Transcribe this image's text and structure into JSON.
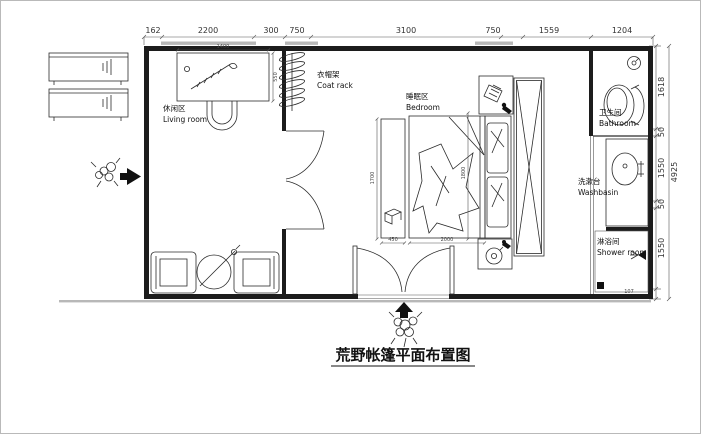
{
  "title": "荒野帐篷平面布置图",
  "rooms": {
    "living": {
      "zh": "休闲区",
      "en": "Living room"
    },
    "coat_rack": {
      "zh": "衣帽架",
      "en": "Coat rack"
    },
    "bedroom": {
      "zh": "睡眠区",
      "en": "Bedroom"
    },
    "bathroom": {
      "zh": "卫生间",
      "en": "Bathroom"
    },
    "washbasin": {
      "zh": "洗漱台",
      "en": "Washbasin"
    },
    "shower": {
      "zh": "淋浴间",
      "en": "Shower room"
    }
  },
  "dims": {
    "top": [
      "162",
      "2200",
      "300",
      "750",
      "3100",
      "750",
      "1559",
      "1204"
    ],
    "right": [
      "1618",
      "50",
      "1550",
      "50",
      "1550",
      "107"
    ],
    "right_total": "4925",
    "interior": {
      "desk_width": "1400",
      "desk_depth": "550",
      "bench_width": "450",
      "bench_length": "1700",
      "bed_width": "2000",
      "bed_length": "1800"
    }
  }
}
